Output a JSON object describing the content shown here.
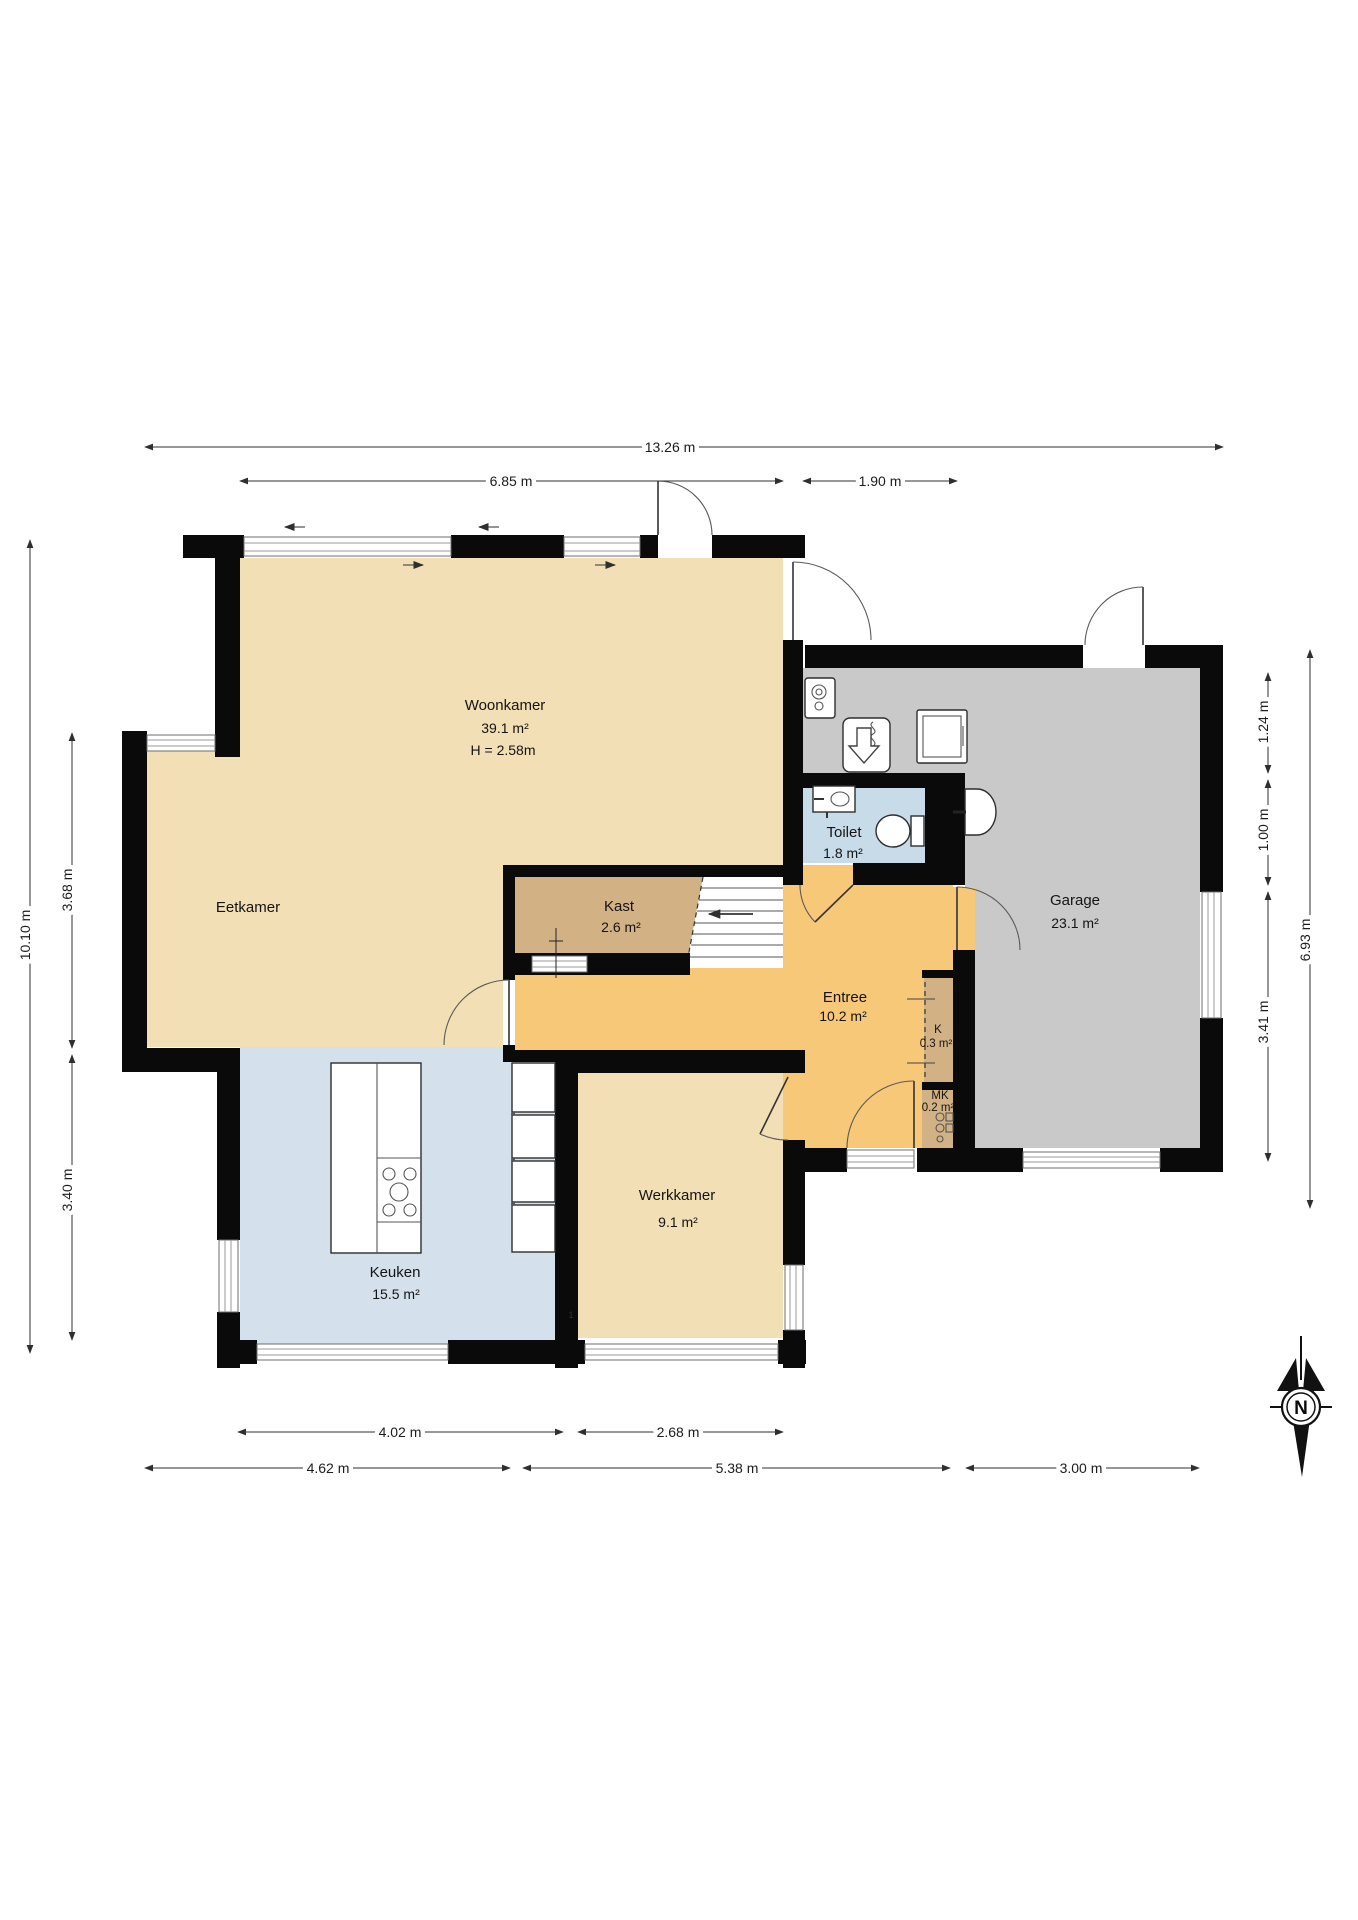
{
  "title": "Floor plan",
  "rooms": {
    "woonkamer": {
      "name": "Woonkamer",
      "area": "39.1 m²",
      "height": "H = 2.58m"
    },
    "eetkamer": {
      "name": "Eetkamer"
    },
    "keuken": {
      "name": "Keuken",
      "area": "15.5 m²"
    },
    "werkkamer": {
      "name": "Werkkamer",
      "area": "9.1 m²"
    },
    "entree": {
      "name": "Entree",
      "area": "10.2 m²"
    },
    "kast": {
      "name": "Kast",
      "area": "2.6 m²"
    },
    "toilet": {
      "name": "Toilet",
      "area": "1.8 m²"
    },
    "k": {
      "name": "K",
      "area": "0.3 m²"
    },
    "mk": {
      "name": "MK",
      "area": "0.2 m²"
    },
    "garage": {
      "name": "Garage",
      "area": "23.1 m²"
    }
  },
  "dimensions": {
    "top_total": "13.26 m",
    "top_left": "6.85 m",
    "top_right": "1.90 m",
    "bottom_kitchen": "4.02 m",
    "bottom_office": "2.68 m",
    "bottom_left": "4.62 m",
    "bottom_mid": "5.38 m",
    "bottom_right": "3.00 m",
    "left_total": "10.10 m",
    "left_upper": "3.68 m",
    "left_lower": "3.40 m",
    "right_seg1": "1.24 m",
    "right_seg2": "1.00 m",
    "right_seg3": "3.41 m",
    "right_total": "6.93 m"
  },
  "compass": {
    "north": "N"
  },
  "annotations": {
    "mark": "1"
  },
  "colors": {
    "living_tan": "#F2DFB5",
    "closet_tan": "#D2B284",
    "entry_orange": "#F6C878",
    "toilet_blue": "#C8DBE8",
    "kitchen_blue": "#D4E1EC",
    "garage_gray": "#C9C9C9",
    "wall_black": "#0a0a0a"
  }
}
